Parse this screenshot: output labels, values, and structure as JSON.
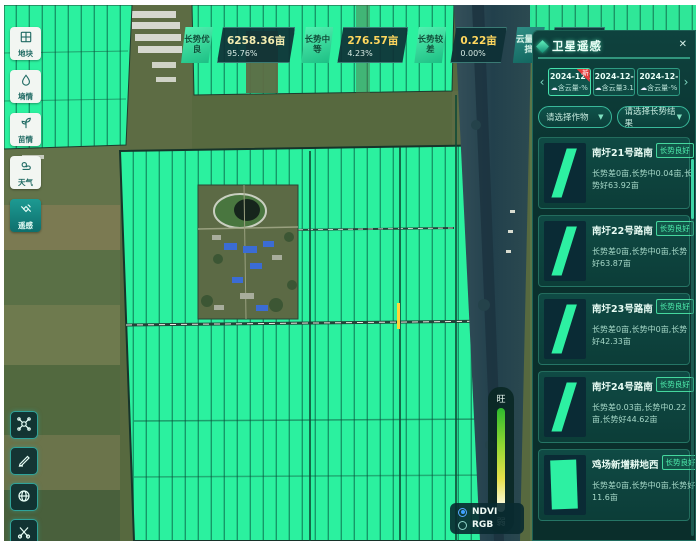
{
  "top_stats": [
    {
      "label": "长势优良",
      "value": "6258.36亩",
      "percent": "95.76%"
    },
    {
      "label": "长势中等",
      "value": "276.57亩",
      "percent": "4.23%"
    },
    {
      "label": "长势较差",
      "value": "0.22亩",
      "percent": "0.00%"
    },
    {
      "label": "云量遮挡",
      "value": "0.00亩",
      "percent": "0%"
    }
  ],
  "sidebar": {
    "items": [
      {
        "label": "地块"
      },
      {
        "label": "墒情"
      },
      {
        "label": "苗情"
      },
      {
        "label": "天气"
      },
      {
        "label": "遥感"
      }
    ]
  },
  "legend": {
    "top": "旺",
    "bottom": "弱"
  },
  "layer_toggle": {
    "options": [
      {
        "label": "NDVI"
      },
      {
        "label": "RGB"
      }
    ]
  },
  "panel": {
    "title": "卫星遥感",
    "close": "✕",
    "prev": "‹",
    "next": "›",
    "caret": "▼",
    "cloud_icon": "☁",
    "dates": [
      {
        "date": "2024-12-24",
        "cloud": "含云量-%",
        "badge": "新"
      },
      {
        "date": "2024-12-19",
        "cloud": "含云量3.13%"
      },
      {
        "date": "2024-12-14",
        "cloud": "含云量-%"
      }
    ],
    "filters": [
      {
        "label": "请选择作物"
      },
      {
        "label": "请选择长势结果"
      }
    ],
    "plots": [
      {
        "title": "南圩21号路南",
        "badge": "长势良好",
        "stats": "长势差0亩,长势中0.04亩,长势好63.92亩"
      },
      {
        "title": "南圩22号路南",
        "badge": "长势良好",
        "stats": "长势差0亩,长势中0亩,长势好63.87亩"
      },
      {
        "title": "南圩23号路南",
        "badge": "长势良好",
        "stats": "长势差0亩,长势中0亩,长势好42.33亩"
      },
      {
        "title": "南圩24号路南",
        "badge": "长势良好",
        "stats": "长势差0.03亩,长势中0.22亩,长势好44.62亩"
      },
      {
        "title": "鸡场新增耕地西",
        "badge": "长势良好",
        "stats": "长势差0亩,长势中0亩,长势好11.6亩"
      }
    ]
  },
  "colors": {
    "field_green": "#2bf19f",
    "panel_teal": "#0d3f3c",
    "accent_green": "#49efae",
    "value_yellow": "#ffd75e",
    "ndvi_strong": "#2eb82e",
    "ndvi_weak": "#ffffff"
  }
}
